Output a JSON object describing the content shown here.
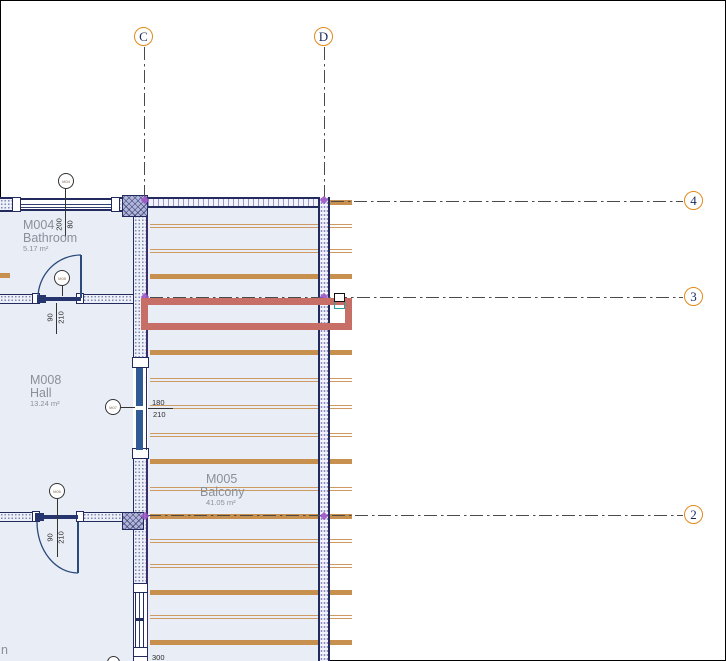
{
  "app": {
    "view_type": "floor-plan-drawing-area"
  },
  "colors": {
    "room_fill": "#e9eef6",
    "wall_navy": "#232a5e",
    "joist_orange": "#c8904e",
    "joist_thin_orange": "#cf9a62",
    "selection_red": "#c76e66",
    "grid_bubble_orange": "#e2891b",
    "grid_line_gray": "#4a4a4a",
    "handle_teal": "#1fa3a3",
    "marker_purple": "#9d55c8",
    "door_panel_blue": "#2f5a94",
    "label_gray": "#8a8f99"
  },
  "grids": {
    "vertical": [
      {
        "label": "C",
        "x": 144,
        "bubble_cy": 37,
        "line_y1": 47,
        "line_y2": 197
      },
      {
        "label": "D",
        "x": 324,
        "bubble_cy": 37,
        "line_y1": 47,
        "line_y2": 197
      }
    ],
    "horizontal": [
      {
        "label": "4",
        "y": 201,
        "bubble_cx": 694,
        "line_x1": 331,
        "line_x2": 683
      },
      {
        "label": "3",
        "y": 297,
        "bubble_cx": 694,
        "line_x1": 150,
        "line_x2": 683
      },
      {
        "label": "2",
        "y": 515,
        "bubble_cx": 694,
        "line_x1": 148,
        "line_x2": 683
      }
    ],
    "markers": [
      {
        "x": 145,
        "y": 200
      },
      {
        "x": 324,
        "y": 200
      },
      {
        "x": 145,
        "y": 297
      },
      {
        "x": 324,
        "y": 297
      },
      {
        "x": 145,
        "y": 516
      },
      {
        "x": 324,
        "y": 516
      }
    ]
  },
  "rooms": [
    {
      "number": "M004",
      "name": "Bathroom",
      "area": "5.17 m²"
    },
    {
      "number": "M008",
      "name": "Hall",
      "area": "13.24 m²"
    },
    {
      "number": "M005",
      "name": "Balcony",
      "area": "41.05 m²"
    }
  ],
  "cut_text": {
    "bottom_left": "n",
    "bottom_dim": "300"
  },
  "dimensions": {
    "window_top": {
      "w": "200",
      "h": "80"
    },
    "door_bathroom": {
      "w": "90",
      "h": "210"
    },
    "door_balcony": {
      "w": "180",
      "h": "210"
    },
    "door_bottom": {
      "w": "90",
      "h": "210"
    }
  },
  "tags": [
    {
      "text": "M04"
    },
    {
      "text": "M08"
    },
    {
      "text": "M07"
    },
    {
      "text": "M06"
    }
  ],
  "joists": {
    "inner_x": 150,
    "inner_w": 168,
    "stub_x": 330,
    "stub_w": 22,
    "lines": [
      {
        "y": 202,
        "thick": true,
        "stub_only": true
      },
      {
        "y": 226,
        "thick": false
      },
      {
        "y": 251,
        "thick": false
      },
      {
        "y": 276,
        "thick": true
      },
      {
        "y": 352,
        "thick": true
      },
      {
        "y": 380,
        "thick": false
      },
      {
        "y": 407,
        "thick": false
      },
      {
        "y": 435,
        "thick": false
      },
      {
        "y": 461,
        "thick": true
      },
      {
        "y": 489,
        "thick": false
      },
      {
        "y": 516,
        "thick": true
      },
      {
        "y": 541,
        "thick": false
      },
      {
        "y": 566,
        "thick": false
      },
      {
        "y": 592,
        "thick": true
      },
      {
        "y": 617,
        "thick": false
      },
      {
        "y": 642,
        "thick": true
      }
    ],
    "left_edge_stub": {
      "x": 0,
      "y": 273,
      "w": 10
    }
  },
  "selection": {
    "x": 141,
    "y": 298,
    "w": 211,
    "h": 32
  }
}
